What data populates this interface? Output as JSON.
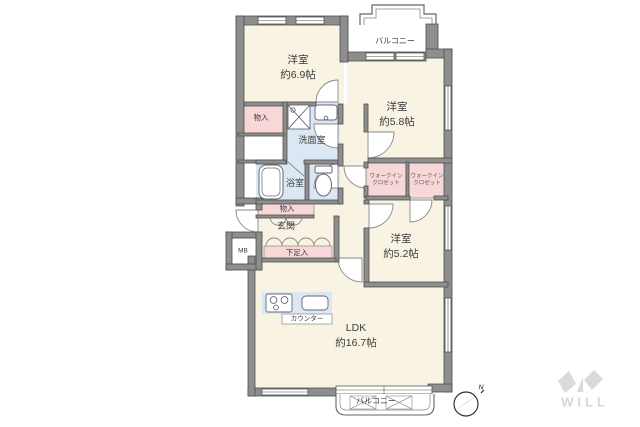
{
  "plan": {
    "rooms": {
      "yoshitsu69": {
        "name": "洋室",
        "size": "約6.9帖"
      },
      "yoshitsu58": {
        "name": "洋室",
        "size": "約5.8帖"
      },
      "yoshitsu52": {
        "name": "洋室",
        "size": "約5.2帖"
      },
      "ldk": {
        "name": "LDK",
        "size": "約16.7帖"
      }
    },
    "labels": {
      "balcony_top": "バルコニー",
      "balcony_bottom": "バルコニー",
      "senmenshitsu": "洗面室",
      "yokushitsu": "浴室",
      "genkan": "玄関",
      "monoire_upper": "物入",
      "monoire_lower": "物入",
      "gesokuiire": "下足入",
      "mb": "MB",
      "wic_line1": "ウォークイン",
      "wic_line2": "クロゼット",
      "counter": "カウンター"
    },
    "compass": {
      "north": "N"
    },
    "watermark": {
      "brand": "WILL"
    },
    "colors": {
      "wall": "#8e8e8e",
      "room_cream": "#f9f3e3",
      "storage_pink": "#f7d7d7",
      "wet_blue": "#dbe7f3",
      "watermark_gray": "#d6d6d6"
    }
  }
}
